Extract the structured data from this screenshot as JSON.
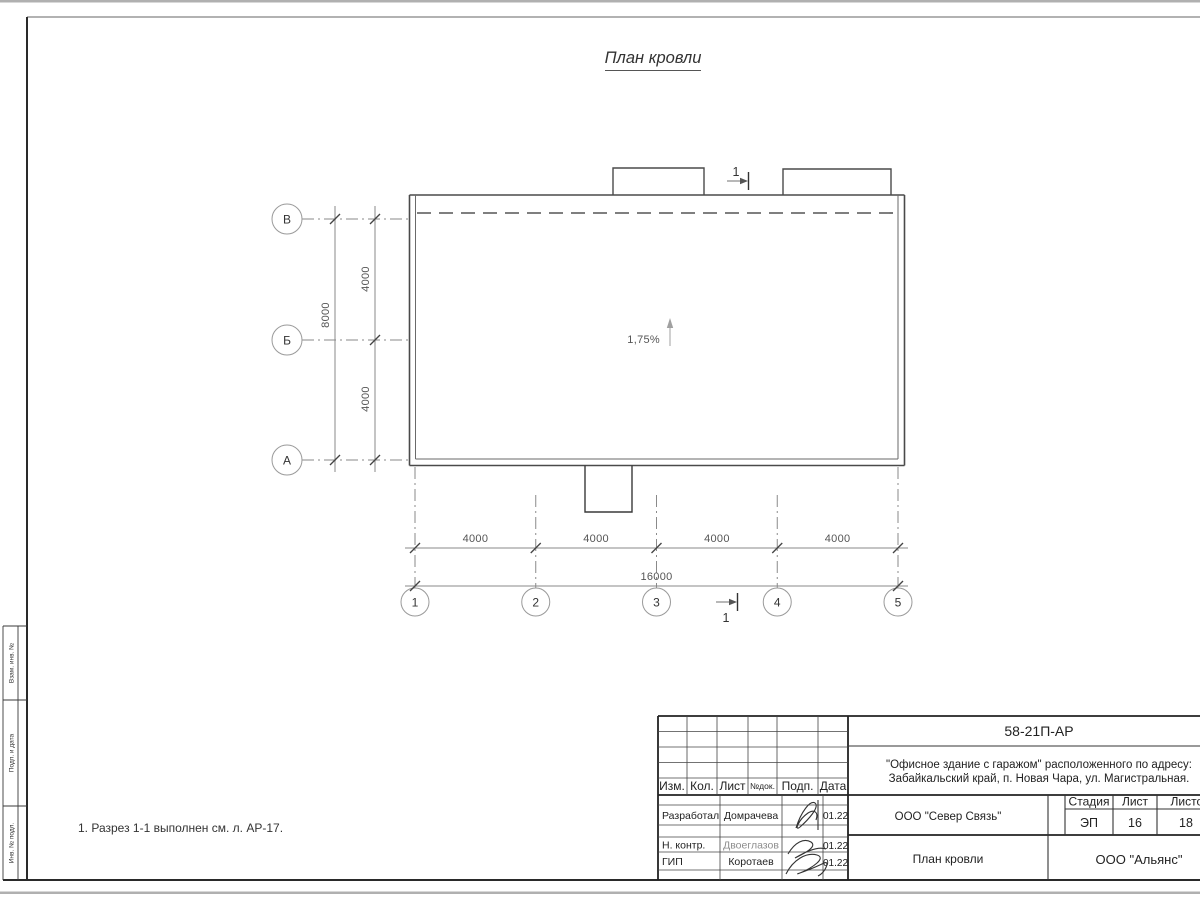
{
  "drawing": {
    "title": "План кровли",
    "note": "1. Разрез 1-1 выполнен см. л. АР-17.",
    "slope": "1,75%",
    "section_mark": "1",
    "axes_cols": [
      "1",
      "2",
      "3",
      "4",
      "5"
    ],
    "axes_rows": [
      "В",
      "Б",
      "А"
    ],
    "dim_col_segments": [
      "4000",
      "4000",
      "4000",
      "4000"
    ],
    "dim_col_total": "16000",
    "dim_row_segments": [
      "4000",
      "4000"
    ],
    "dim_row_total": "8000"
  },
  "side_stamp": {
    "cells": [
      "Взам. инв. №",
      "Подп. и дата",
      "Инв. № подл."
    ]
  },
  "title_block": {
    "doc_number": "58-21П-АР",
    "project_line1": "\"Офисное здание с гаражом\" расположенного по адресу:",
    "project_line2": "Забайкальский край, п. Новая Чара, ул. Магистральная.",
    "columns": [
      "Изм.",
      "Кол.",
      "Лист",
      "№док.",
      "Подп.",
      "Дата"
    ],
    "rows": [
      {
        "role": "Разработал",
        "name": "Домрачева",
        "date": "01.22"
      },
      {
        "role": "Н. контр.",
        "name": "Двоеглазов",
        "date": "01.22"
      },
      {
        "role": "ГИП",
        "name": "Коротаев",
        "date": "01.22"
      }
    ],
    "org": "ООО \"Север Связь\"",
    "stage_label": "Стадия",
    "sheet_label": "Лист",
    "sheets_label": "Листов",
    "stage": "ЭП",
    "sheet": "16",
    "sheets": "18",
    "drawing_name": "План кровли",
    "company": "ООО \"Альянс\""
  },
  "colors": {
    "outline": "#4a4a4a",
    "thin_line": "#8a8a8a",
    "frame": "#222222",
    "page_edge": "#b0b0b0"
  }
}
